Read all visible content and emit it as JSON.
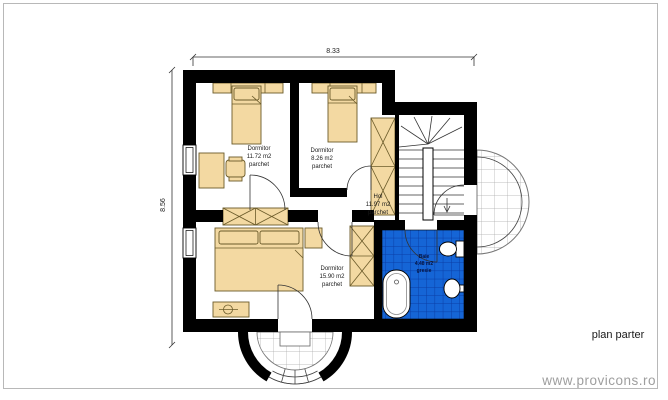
{
  "page": {
    "caption": "plan parter",
    "watermark": "www.provicons.ro"
  },
  "dimensions": {
    "width_label": "8.33",
    "height_label": "8.56"
  },
  "rooms": {
    "bedroom1": {
      "name": "Dormitor",
      "area": "11.72 m2",
      "floor": "parchet"
    },
    "bedroom2": {
      "name": "Dormitor",
      "area": "8.26 m2",
      "floor": "parchet"
    },
    "hall": {
      "name": "Hol",
      "area": "11.97 m2",
      "floor": "parchet"
    },
    "bedroom3": {
      "name": "Dormitor",
      "area": "15.90 m2",
      "floor": "parchet"
    },
    "bathroom": {
      "name": "Baie",
      "area": "4.48 m2",
      "floor": "gresie"
    }
  },
  "colors": {
    "wall": "#000000",
    "furniture": "#F3D9A2",
    "furniture_outline": "#6B5B2A",
    "bathroom_tile": "#1565D6",
    "bathroom_grid": "#0A3DA6",
    "frame": "#B8B8B8",
    "watermark": "#9E9E9E"
  }
}
